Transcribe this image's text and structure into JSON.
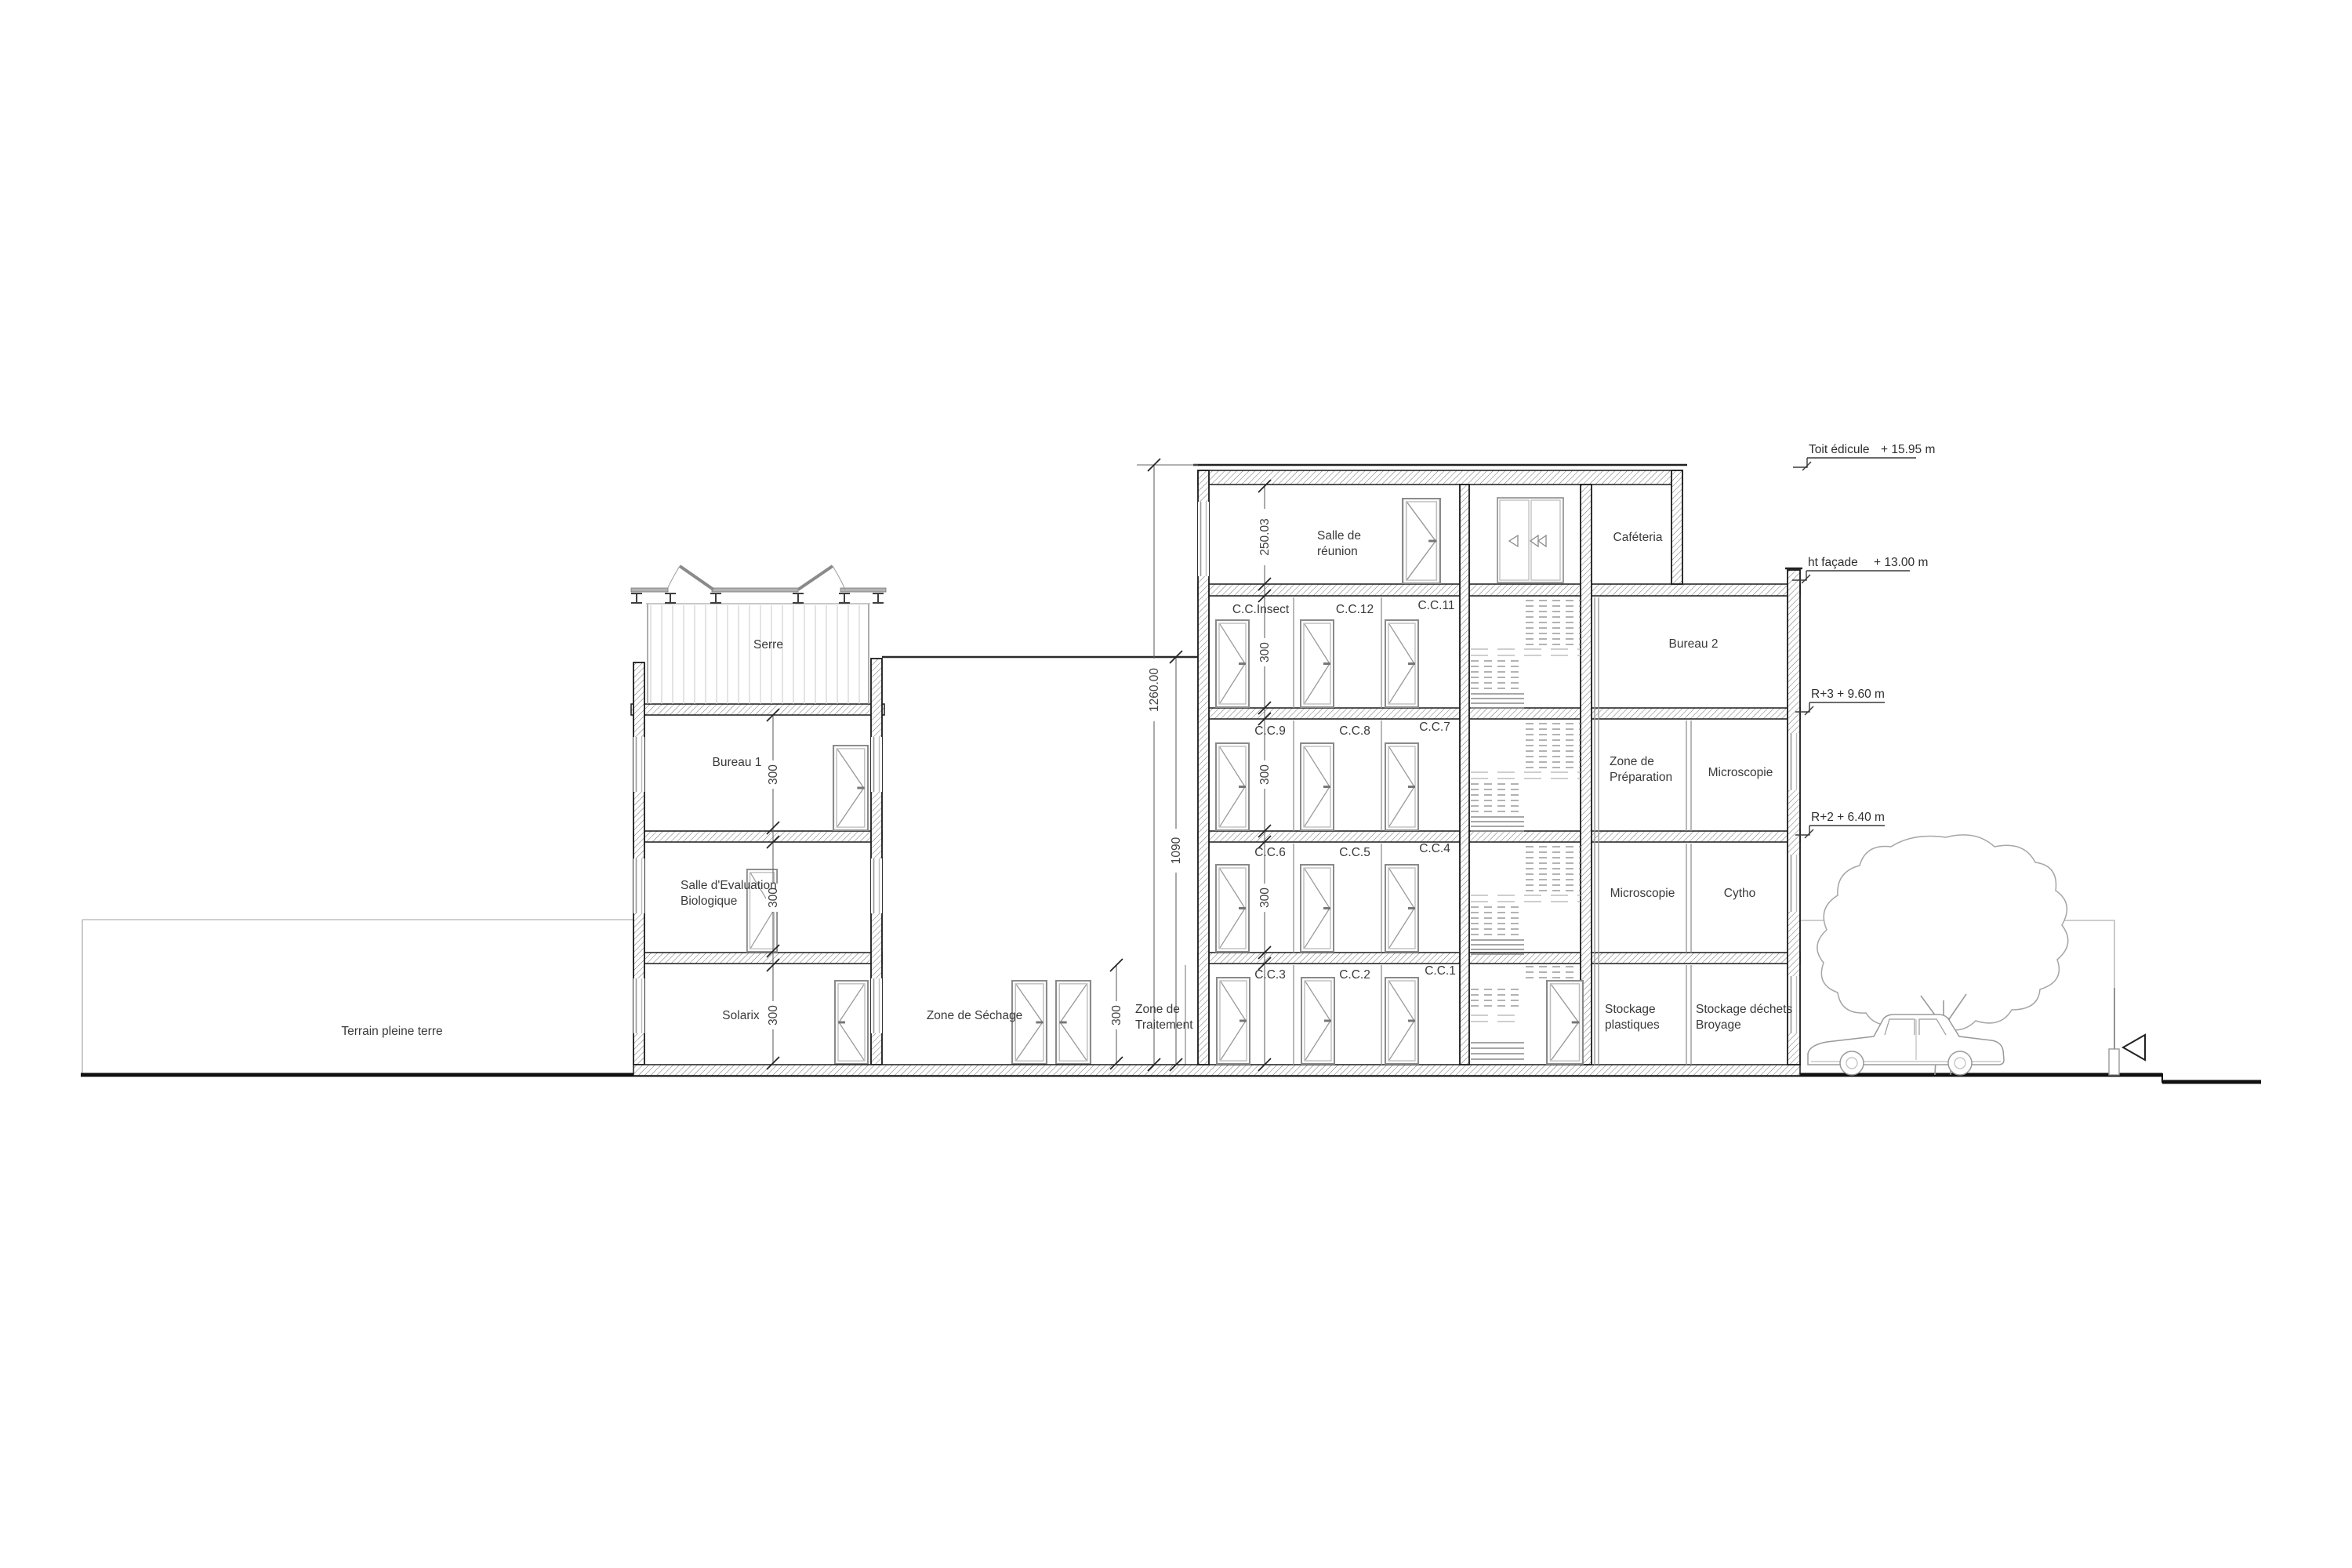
{
  "drawing": {
    "rooms": {
      "serre": "Serre",
      "bureau1": "Bureau 1",
      "salle_eval": [
        "Salle d'Evaluation",
        "Biologique"
      ],
      "solarix": "Solarix",
      "zone_sechage": "Zone de Séchage",
      "zone_traitement": [
        "Zone de",
        "Traitement"
      ],
      "salle_reunion": [
        "Salle de",
        "réunion"
      ],
      "cafeteria": "Caféteria",
      "bureau2": "Bureau 2",
      "zone_preparation": [
        "Zone de",
        "Préparation"
      ],
      "microscopie_r2": "Microscopie",
      "microscopie_r1": "Microscopie",
      "cytho": "Cytho",
      "stockage_plastiques": [
        "Stockage",
        "plastiques"
      ],
      "stockage_dechets": [
        "Stockage déchets",
        "Broyage"
      ],
      "cc_insect": "C.C.Insect",
      "cc12": "C.C.12",
      "cc11": "C.C.11",
      "cc9": "C.C.9",
      "cc8": "C.C.8",
      "cc7": "C.C.7",
      "cc6": "C.C.6",
      "cc5": "C.C.5",
      "cc4": "C.C.4",
      "cc3": "C.C.3",
      "cc2": "C.C.2",
      "cc1": "C.C.1"
    },
    "site": {
      "terrain": "Terrain pleine terre"
    },
    "dimensions": {
      "top_floor_height": "250.03",
      "typ_floor_height": "300",
      "total_height": "1260.00",
      "hall_height": "1090"
    },
    "levels": {
      "toit_name": "Toit édicule",
      "toit_value": "+ 15.95 m",
      "facade_name": "ht façade",
      "facade_value": "+ 13.00 m",
      "r3": "R+3 + 9.60 m",
      "r2": "R+2 + 6.40 m"
    }
  }
}
